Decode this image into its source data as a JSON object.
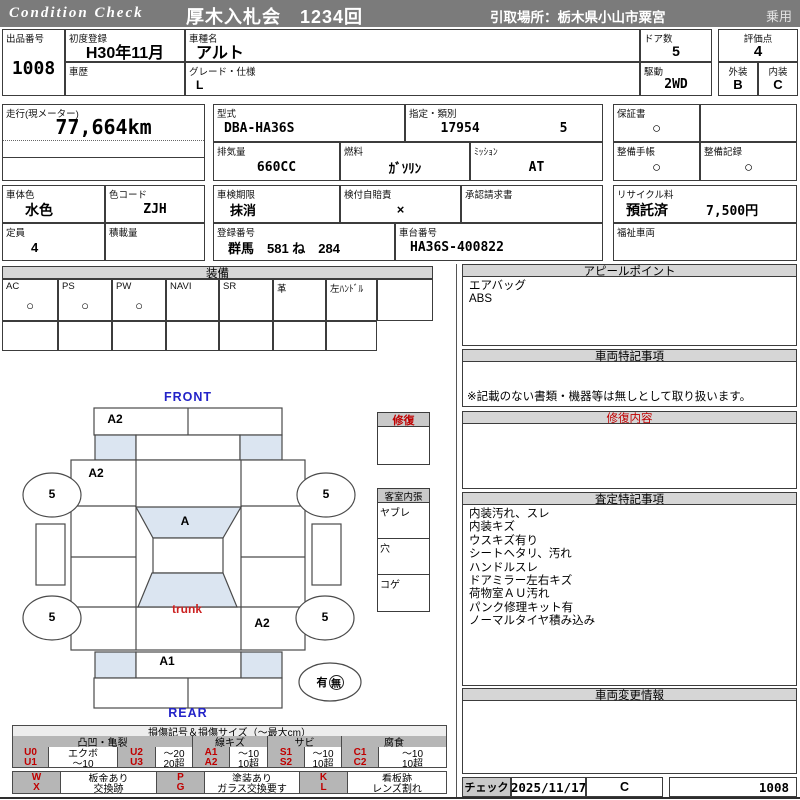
{
  "header": {
    "brand": "Condition  Check",
    "auction": "厚木入札会　1234回",
    "pickup": "引取場所：栃木県小山市粟宮",
    "usage": "乗用"
  },
  "top": {
    "lot": {
      "label": "出品番号",
      "value": "1008"
    },
    "first_reg": {
      "label": "初度登録",
      "value": "H30年11月"
    },
    "history": {
      "label": "車歴",
      "value": ""
    },
    "model": {
      "label": "車種名",
      "value": "アルト"
    },
    "grade": {
      "label": "グレード・仕様",
      "value": "L"
    },
    "doors": {
      "label": "ドア数",
      "value": "5"
    },
    "drive": {
      "label": "駆動",
      "value": "2WD"
    },
    "score": {
      "label": "評価点",
      "value": "4"
    },
    "exterior": {
      "label": "外装",
      "value": "B"
    },
    "interior": {
      "label": "内装",
      "value": "C"
    }
  },
  "spec": {
    "mileage": {
      "label": "走行(現メーター)",
      "value": "77,664km"
    },
    "model_code": {
      "label": "型式",
      "value": "DBA-HA36S"
    },
    "class": {
      "label": "指定・類別",
      "value1": "17954",
      "value2": "5"
    },
    "warranty": {
      "label": "保証書",
      "value": "○"
    },
    "displacement": {
      "label": "排気量",
      "value": "660CC"
    },
    "fuel": {
      "label": "燃料",
      "value": "ｶﾞｿﾘﾝ"
    },
    "mission": {
      "label": "ﾐｯｼｮﾝ",
      "value": "AT"
    },
    "m_book": {
      "label": "整備手帳",
      "value": "○"
    },
    "m_record": {
      "label": "整備記録",
      "value": "○"
    }
  },
  "status": {
    "body_color": {
      "label": "車体色",
      "value": "水色"
    },
    "color_code": {
      "label": "色コード",
      "value": "ZJH"
    },
    "inspection": {
      "label": "車検期限",
      "value": "抹消"
    },
    "jibai": {
      "label": "検付自賠責",
      "value": "×"
    },
    "approval": {
      "label": "承認請求書",
      "value": ""
    },
    "recycle": {
      "label": "リサイクル料",
      "value": "預託済",
      "fee": "7,500円"
    },
    "capacity": {
      "label": "定員",
      "value": "4"
    },
    "load": {
      "label": "積載量",
      "value": ""
    },
    "plate": {
      "label": "登録番号",
      "value": "群馬　581 ね　284"
    },
    "vin": {
      "label": "車台番号",
      "value": "HA36S-400822"
    },
    "welfare": {
      "label": "福祉車両",
      "value": ""
    }
  },
  "equipment": {
    "title": "装備",
    "items": [
      {
        "label": "AC",
        "value": "○"
      },
      {
        "label": "PS",
        "value": "○"
      },
      {
        "label": "PW",
        "value": "○"
      },
      {
        "label": "NAVI",
        "value": ""
      },
      {
        "label": "SR",
        "value": ""
      },
      {
        "label": "革",
        "value": ""
      },
      {
        "label": "左ﾊﾝﾄﾞﾙ",
        "value": ""
      }
    ]
  },
  "panels": {
    "appeal": {
      "title": "アピールポイント",
      "lines": [
        "エアバッグ",
        "ABS"
      ]
    },
    "special": {
      "title": "車両特記事項",
      "note": "※記載のない書類・機器等は無しとして取り扱います。"
    },
    "repair": {
      "title": "修復内容"
    },
    "assessment": {
      "title": "査定特記事項",
      "lines": [
        "内装汚れ、スレ",
        "内装キズ",
        "ウスキズ有り",
        "シートヘタリ、汚れ",
        "ハンドルスレ",
        "ドアミラー左右キズ",
        "荷物室ＡＵ汚れ",
        "パンク修理キット有",
        "ノーマルタイヤ積み込み"
      ]
    },
    "change": {
      "title": "車両変更情報"
    }
  },
  "diagram": {
    "front": "FRONT",
    "rear": "REAR",
    "marks": {
      "front_bumper": "A2",
      "left_front": "A2",
      "windshield": "A",
      "trunk": "trunk",
      "rear_right": "A2",
      "rear_panel": "A1",
      "wheel": "5"
    },
    "spare": {
      "has": "有",
      "none": "無"
    },
    "repair_box": {
      "title": "修復"
    },
    "cabin": {
      "title": "客室内張",
      "rows": [
        "ヤブレ",
        "穴",
        "コゲ"
      ]
    }
  },
  "legend": {
    "title": "損傷記号＆損傷サイズ（～最大cm）",
    "cat1": "凸凹・亀裂",
    "cat2": "線キズ",
    "cat3": "サビ",
    "cat4": "腐食",
    "cells_row1": [
      "U0",
      "エクボ",
      "U2",
      "～20",
      "A1",
      "～10",
      "S1",
      "～10",
      "C1",
      "～10"
    ],
    "cells_row2": [
      "U1",
      "～10",
      "U3",
      "20超",
      "A2",
      "10超",
      "S2",
      "10超",
      "C2",
      "10超"
    ],
    "extra_row1": [
      "W",
      "板金あり",
      "P",
      "塗装あり",
      "K",
      "看板跡"
    ],
    "extra_row2": [
      "X",
      "交換跡",
      "G",
      "ガラス交換要す",
      "L",
      "レンズ割れ"
    ]
  },
  "footer": {
    "check": "チェック",
    "date": "2025/11/17",
    "grade": "C",
    "lot": "1008"
  }
}
